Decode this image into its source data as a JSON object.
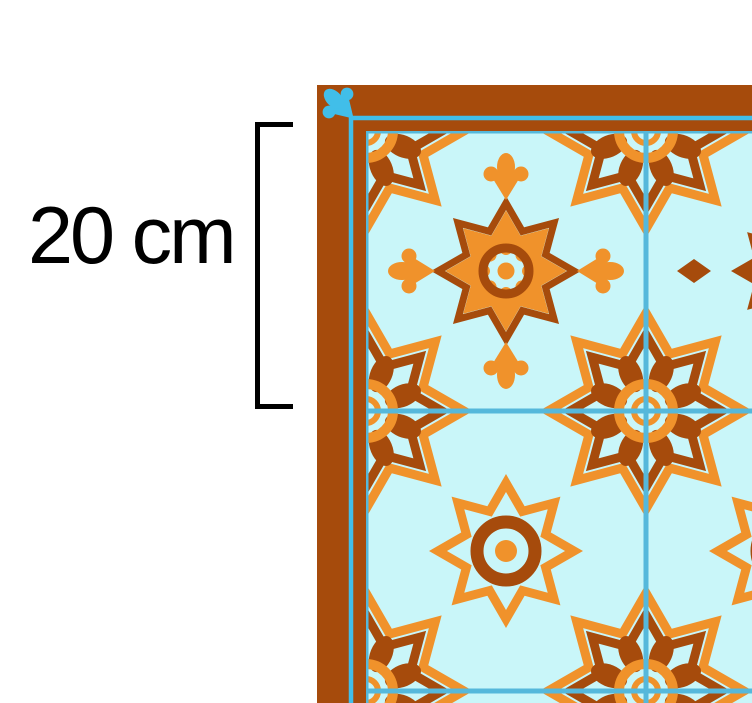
{
  "page": {
    "background": "#FFFFFF"
  },
  "annotation": {
    "dimension_label": "20 cm"
  },
  "rug": {
    "colors": {
      "border_brown": "#A64B0C",
      "pattern_brown": "#A64B0C",
      "pattern_orange": "#F0922B",
      "tile_background": "#C9F6F9",
      "grout_cyan": "#55B8DB",
      "edge_line_cyan": "#41BEE9"
    },
    "motifs": [
      "corner-star-rosette",
      "eight-petal-flower-medallion",
      "ring-star-medallion",
      "stepped-cross-medallion",
      "tulip-motif",
      "diamond-motif",
      "corner-leaf-marker"
    ]
  }
}
